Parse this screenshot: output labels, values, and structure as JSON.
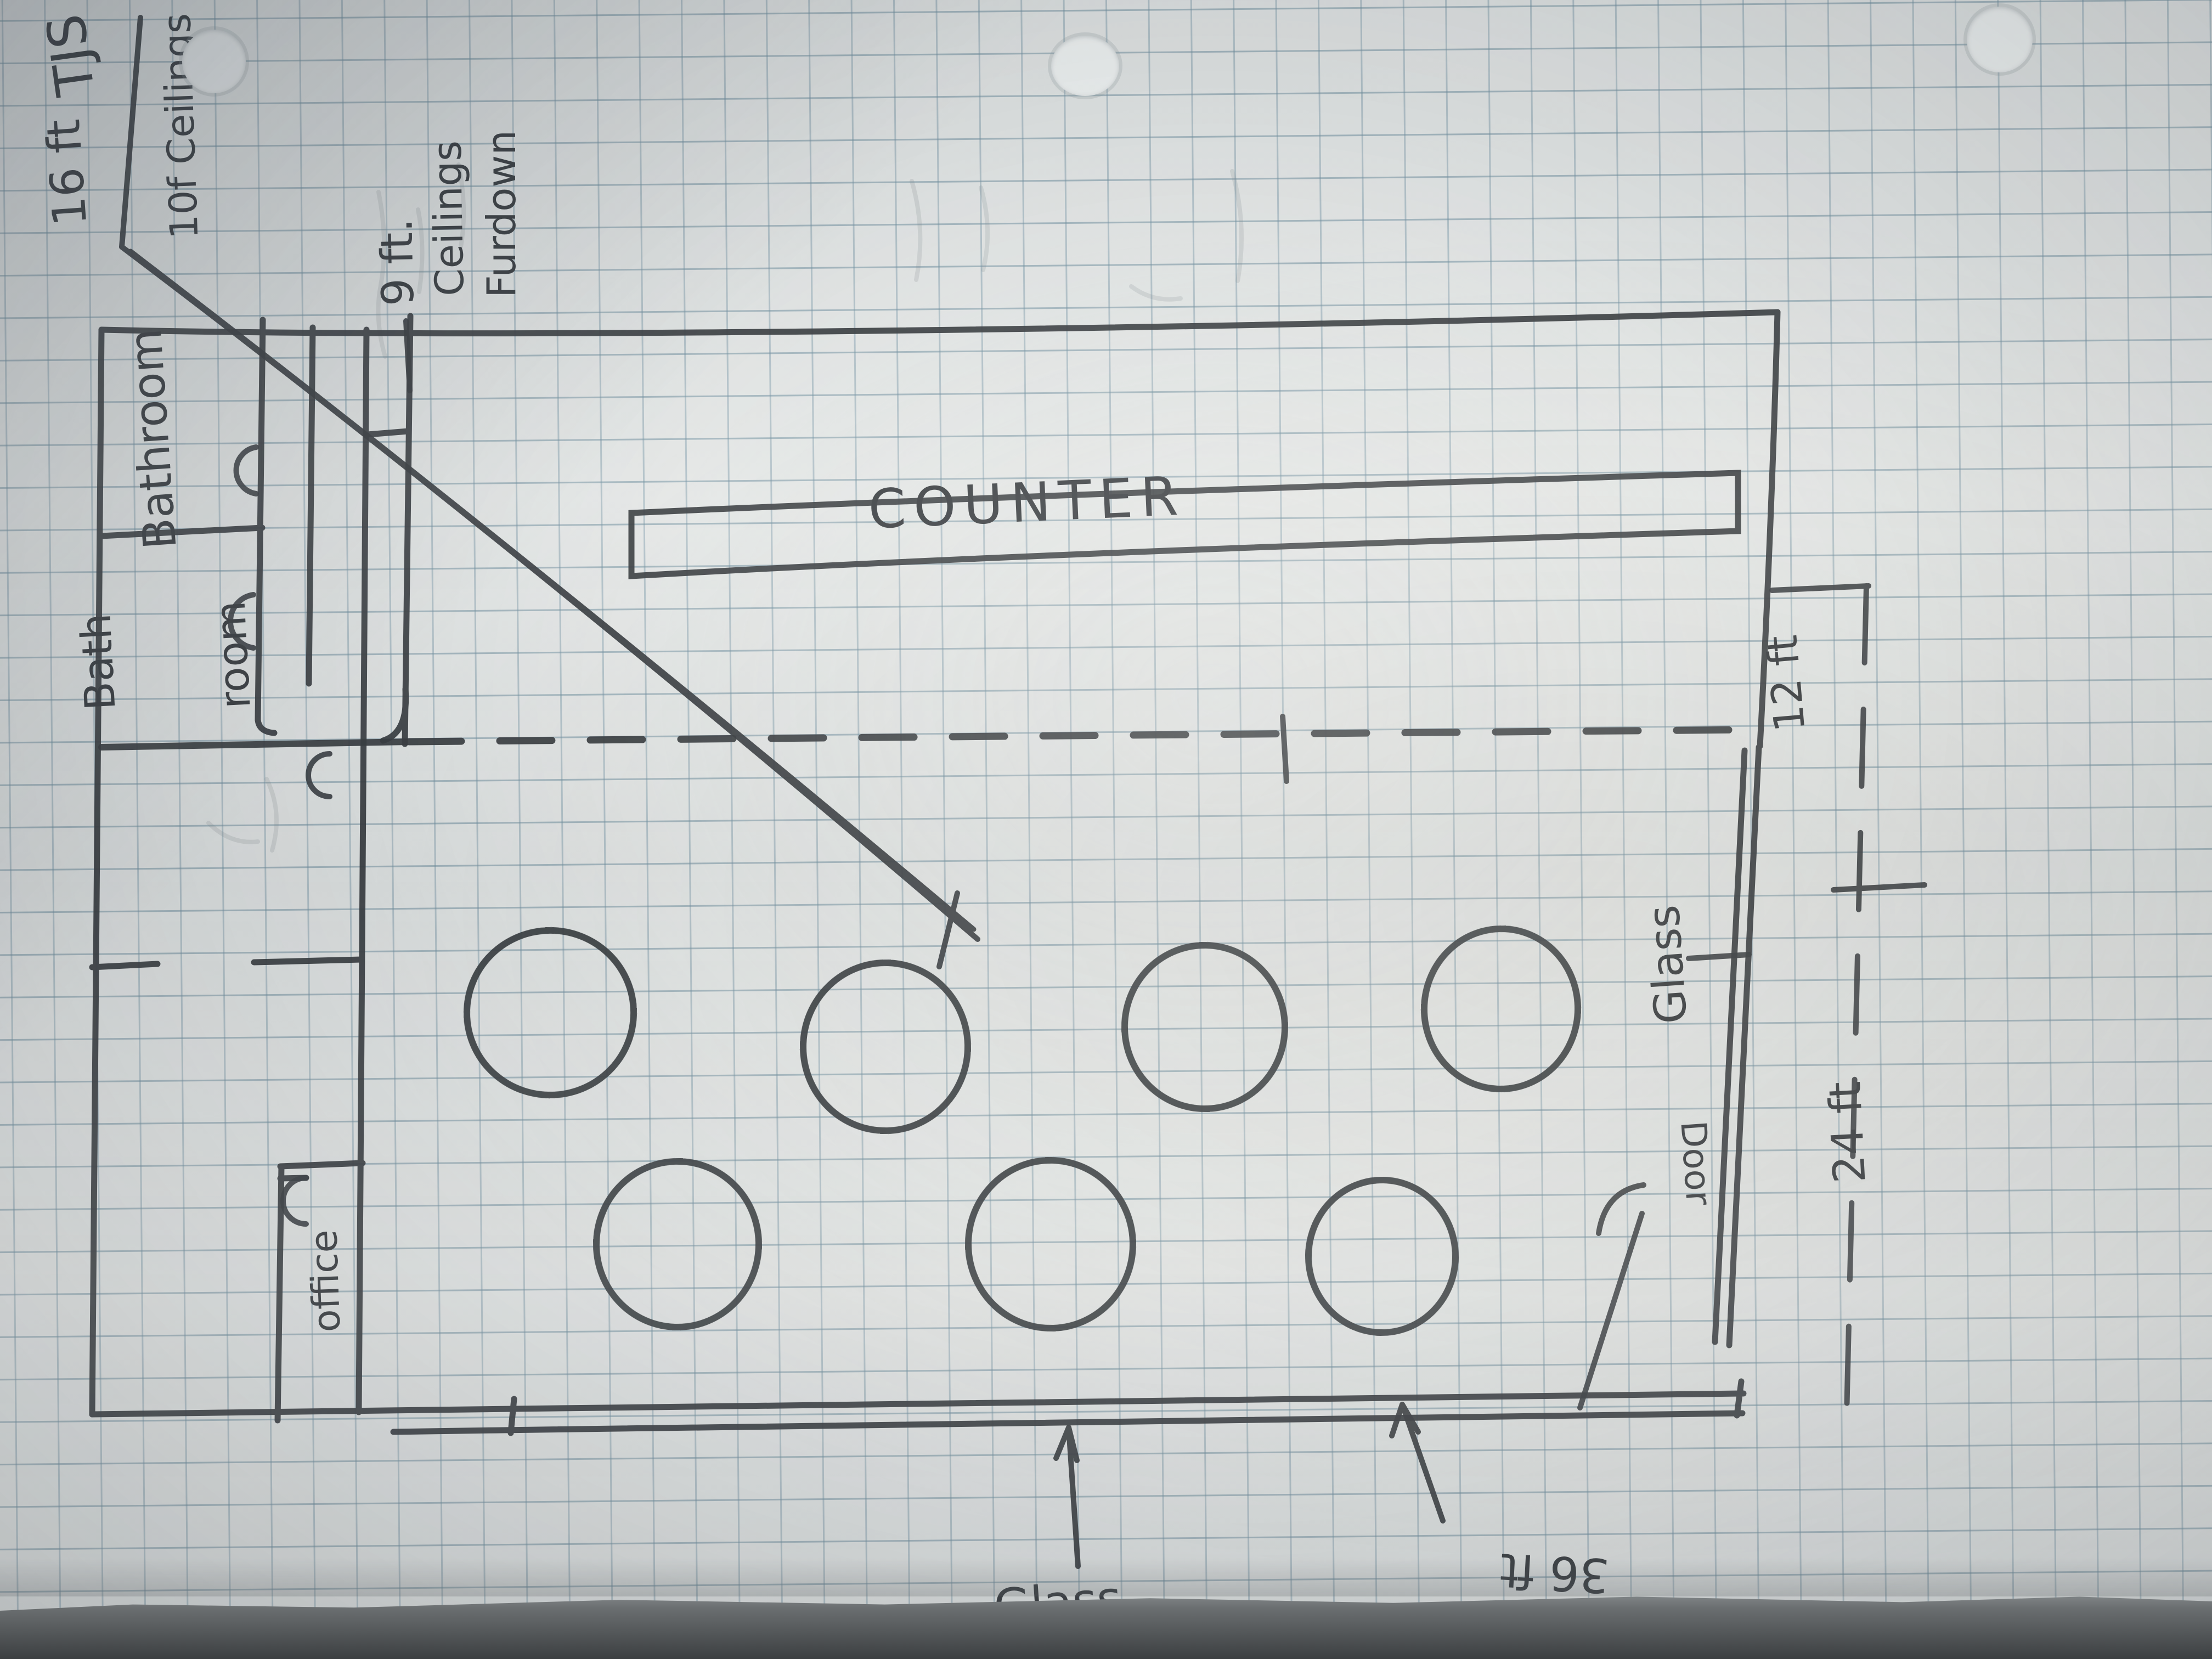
{
  "scene": {
    "kind": "hand-drawn restaurant floor plan sketch on blue graph paper",
    "paper": "graph paper with three hole punches, photographed on a dark table"
  },
  "colors": {
    "ink": "#2f3337",
    "grid_line": "#9cb3bf",
    "paper": "#e3e6e5",
    "table": "#3c3f41"
  },
  "annotations": {
    "length_16ft": "16 ft",
    "joists": "TJS",
    "ceiling_main": "10f Ceilings",
    "soffit_l1": "9 ft.",
    "soffit_l2": "Ceilings",
    "soffit_l3": "Furdown",
    "dim_12ft": "12 ft",
    "dim_24ft": "24 ft",
    "dim_36ft": "36 ft",
    "glass_right": "Glass",
    "glass_front": "Glass",
    "door": "Door"
  },
  "rooms": {
    "bathroom_top": "Bathroom",
    "bathroom_bottom_l1": "Bath",
    "bathroom_bottom_l2": "room",
    "office": "office",
    "counter": "COUNTER"
  },
  "furniture": {
    "round_tables_count": "7"
  }
}
